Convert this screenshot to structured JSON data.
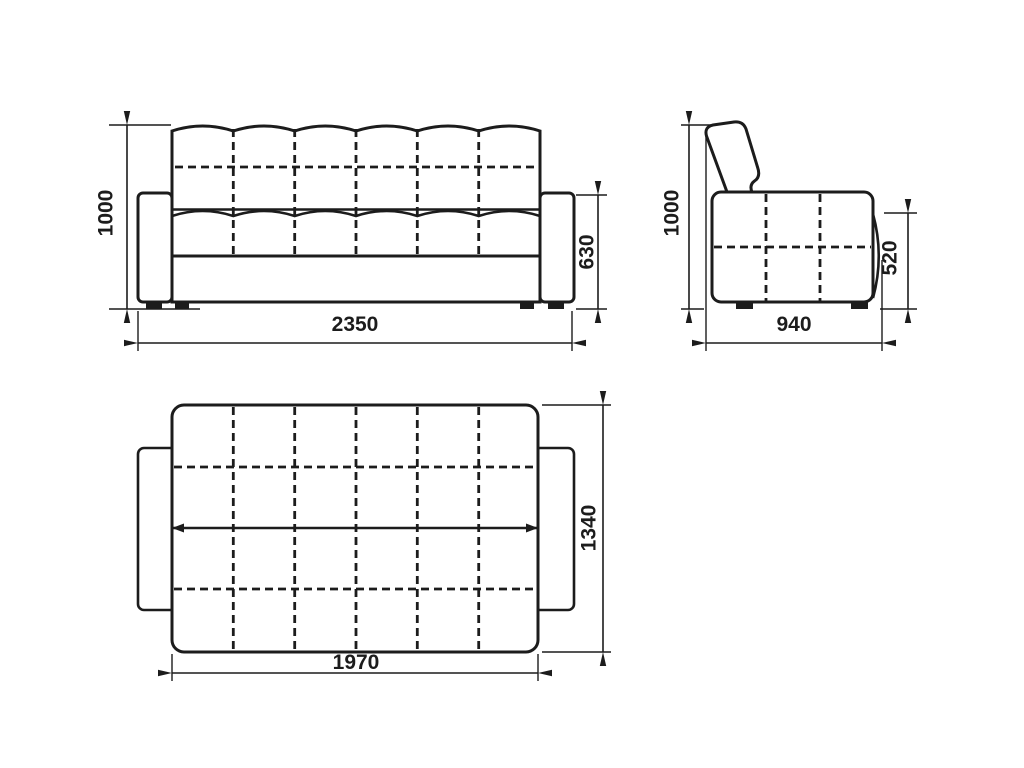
{
  "drawing": {
    "kind": "furniture-dimension-drawing",
    "views": {
      "front": {
        "height_label": "1000",
        "armrest_height_label": "630",
        "width_label": "2350"
      },
      "side": {
        "height_label": "1000",
        "armrest_height_label": "520",
        "depth_label": "940"
      },
      "top": {
        "depth_label": "1340",
        "length_label": "1970"
      }
    },
    "colors": {
      "line": "#1c1c1c",
      "background": "#ffffff"
    }
  }
}
